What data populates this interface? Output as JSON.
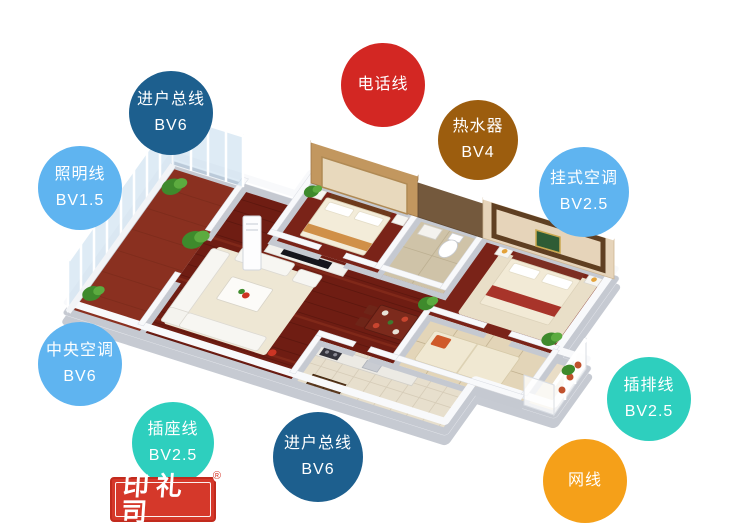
{
  "background": "#ffffff",
  "badges": [
    {
      "id": "incoming-mains-top",
      "lines": [
        "进户总线",
        "BV6"
      ],
      "color": "#1d5f8e",
      "text_color": "#ffffff",
      "x": 129,
      "y": 71,
      "d": 84
    },
    {
      "id": "lighting-line",
      "lines": [
        "照明线",
        "BV1.5"
      ],
      "color": "#5fb4f0",
      "text_color": "#ffffff",
      "x": 38,
      "y": 146,
      "d": 84
    },
    {
      "id": "telephone-line",
      "lines": [
        "电话线"
      ],
      "color": "#d32723",
      "text_color": "#ffffff",
      "x": 341,
      "y": 43,
      "d": 84
    },
    {
      "id": "water-heater",
      "lines": [
        "热水器",
        "BV4"
      ],
      "color": "#9c5d0e",
      "text_color": "#ffffff",
      "x": 438,
      "y": 100,
      "d": 80
    },
    {
      "id": "wall-mounted-ac",
      "lines": [
        "挂式空调",
        "BV2.5"
      ],
      "color": "#5fb4f0",
      "text_color": "#ffffff",
      "x": 539,
      "y": 147,
      "d": 90
    },
    {
      "id": "central-ac",
      "lines": [
        "中央空调",
        "BV6"
      ],
      "color": "#5fb4f0",
      "text_color": "#ffffff",
      "x": 38,
      "y": 322,
      "d": 84
    },
    {
      "id": "socket-line",
      "lines": [
        "插座线",
        "BV2.5"
      ],
      "color": "#2ecfbe",
      "text_color": "#ffffff",
      "x": 132,
      "y": 402,
      "d": 82
    },
    {
      "id": "incoming-mains-bottom",
      "lines": [
        "进户总线",
        "BV6"
      ],
      "color": "#1d5f8e",
      "text_color": "#ffffff",
      "x": 273,
      "y": 412,
      "d": 90
    },
    {
      "id": "power-strip-line",
      "lines": [
        "插排线",
        "BV2.5"
      ],
      "color": "#2ecfbe",
      "text_color": "#ffffff",
      "x": 607,
      "y": 357,
      "d": 84
    },
    {
      "id": "network-cable",
      "lines": [
        "网线"
      ],
      "color": "#f5a019",
      "text_color": "#ffffff",
      "x": 543,
      "y": 439,
      "d": 84
    }
  ],
  "logo": {
    "text": "印礼司",
    "registered": "®",
    "background": "#d5382a",
    "text_color": "#ffffff"
  },
  "floorplan_palette": {
    "wood_floor": "#6f1d13",
    "bedroom_wood": "#7a2318",
    "beige_floor": "#e3d5b8",
    "kitchen_floor": "#e7dfcd",
    "wall_top": "#f8f9fb",
    "wall_side": "#c5c9d1",
    "glass": "#bdd5e9",
    "feature_wall_tan": "#c2975f",
    "feature_wall_brown": "#74593d"
  }
}
